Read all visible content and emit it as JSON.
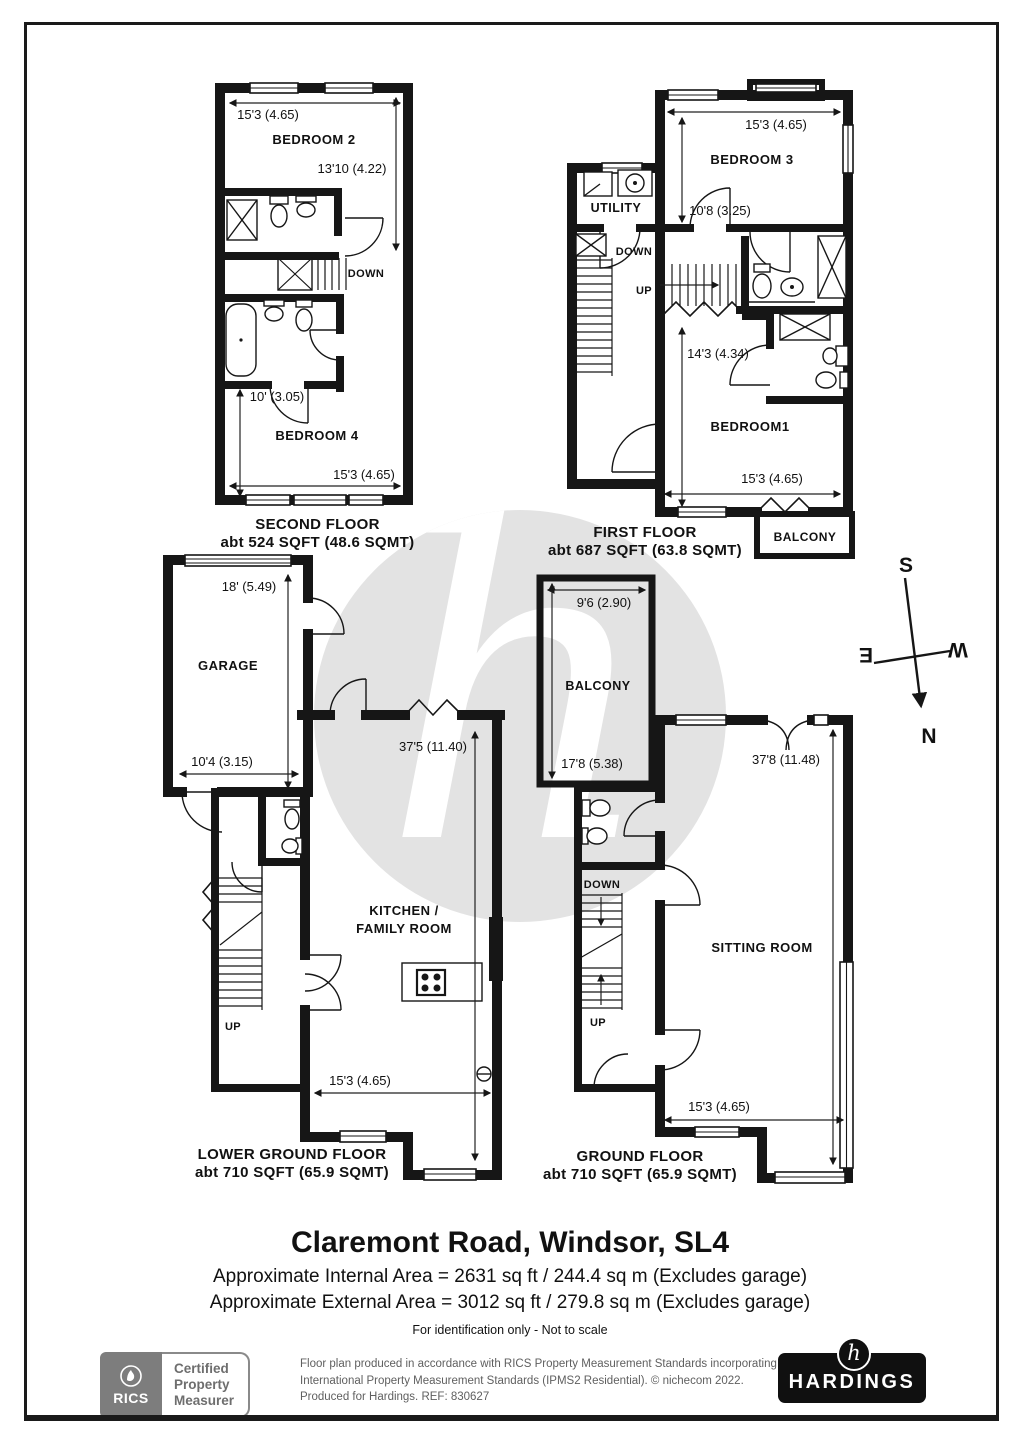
{
  "watermark": {
    "letter": "h"
  },
  "compass": {
    "north": "N",
    "south": "S",
    "east": "E",
    "west": "W"
  },
  "floors": {
    "second": {
      "name": "SECOND FLOOR",
      "area": "abt 524 SQFT (48.6 SQMT)",
      "rooms": {
        "bedroom2": "BEDROOM 2",
        "bedroom4": "BEDROOM 4"
      },
      "labels": {
        "down": "DOWN"
      },
      "dims": {
        "top": "15'3 (4.65)",
        "right": "13'10 (4.22)",
        "bed4": "10' (3.05)",
        "bottom": "15'3 (4.65)"
      }
    },
    "first": {
      "name": "FIRST FLOOR",
      "area": "abt 687 SQFT (63.8 SQMT)",
      "rooms": {
        "bedroom3": "BEDROOM 3",
        "utility": "UTILITY",
        "bedroom1": "BEDROOM1",
        "balcony": "BALCONY"
      },
      "labels": {
        "down": "DOWN",
        "up": "UP"
      },
      "dims": {
        "top": "15'3 (4.65)",
        "bed3": "10'8 (3.25)",
        "mid": "14'3 (4.34)",
        "bottom": "15'3 (4.65)"
      }
    },
    "lower_ground": {
      "name": "LOWER GROUND FLOOR",
      "area": "abt 710 SQFT (65.9 SQMT)",
      "rooms": {
        "garage": "GARAGE",
        "kitchen_line1": "KITCHEN /",
        "kitchen_line2": "FAMILY ROOM"
      },
      "labels": {
        "up": "UP"
      },
      "dims": {
        "garage_top": "18' (5.49)",
        "garage_bottom": "10'4 (3.15)",
        "length": "37'5 (11.40)",
        "bottom": "15'3 (4.65)"
      }
    },
    "ground": {
      "name": "GROUND FLOOR",
      "area": "abt 710 SQFT (65.9 SQMT)",
      "rooms": {
        "balcony": "BALCONY",
        "sitting": "SITTING ROOM"
      },
      "labels": {
        "down": "DOWN",
        "up": "UP"
      },
      "dims": {
        "balcony_top": "9'6 (2.90)",
        "balcony_left": "17'8 (5.38)",
        "length": "37'8 (11.48)",
        "bottom": "15'3 (4.65)"
      }
    }
  },
  "title_block": {
    "address": "Claremont Road, Windsor, SL4",
    "internal_area": "Approximate Internal Area = 2631 sq ft / 244.4 sq m (Excludes garage)",
    "external_area": "Approximate External Area = 3012 sq ft / 279.8 sq m (Excludes garage)",
    "note": "For identification only - Not to scale"
  },
  "footer": {
    "rics": {
      "brand": "RICS",
      "line1": "Certified",
      "line2": "Property",
      "line3": "Measurer"
    },
    "disclaimer_line1": "Floor plan produced in accordance with RICS Property Measurement Standards incorporating",
    "disclaimer_line2": "International Property Measurement Standards (IPMS2 Residential).  © nichecom 2022.",
    "disclaimer_line3": "Produced for Hardings.   REF:  830627",
    "hardings": {
      "logo_letter": "h",
      "brand": "HARDINGS"
    }
  }
}
